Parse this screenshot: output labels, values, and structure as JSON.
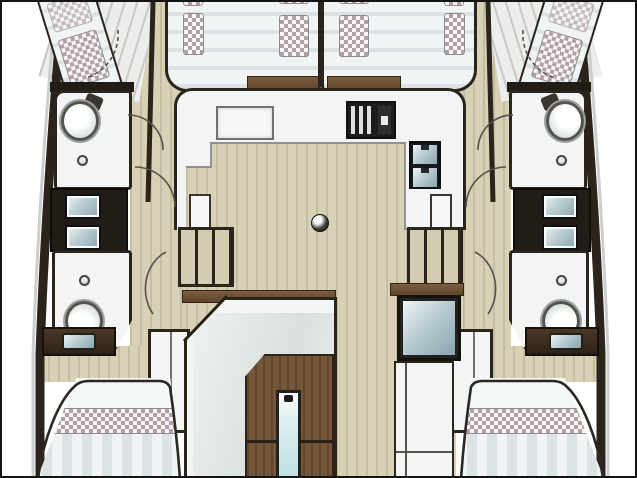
{
  "window": {
    "width": 637,
    "height": 478
  },
  "diagram": {
    "type": "catamaran-interior-deck-plan",
    "view": "top-down",
    "text_labels": [],
    "components": [
      "forward-double-berth-port",
      "forward-double-berth-starboard",
      "hull-diagonal-berth-port",
      "hull-diagonal-berth-starboard",
      "bathroom-forward-port",
      "bathroom-forward-starboard",
      "bathroom-aft-port",
      "bathroom-aft-starboard",
      "toilet",
      "washbasin",
      "vanity-double-sink",
      "salon",
      "galley-counter",
      "galley-stove",
      "galley-double-sink-fridge",
      "counter-hatch",
      "floor-hatch-ring",
      "stairs-port",
      "stairs-starboard",
      "door-swing-arc",
      "companionway-wood-doors",
      "glazed-door-strip",
      "aft-skylight-window",
      "aft-cabin-bed-port",
      "aft-cabin-bed-starboard",
      "vanity-desk-with-seat-port",
      "vanity-desk-with-seat-starboard",
      "wardrobe-port",
      "wardrobe-starboard"
    ]
  },
  "palette": {
    "paper": "#ffffff",
    "frame": "#141414",
    "ink": "#2b241d",
    "wall_dark": "#221c16",
    "wood": "#74563a",
    "wood_dark": "#302417",
    "wood_band_a": "#7d5e3e",
    "wood_band_b": "#5d452c",
    "floor": "#d8d1b5",
    "deck": "#d3ccb0",
    "room": "#f3f5f5",
    "mattress_a": "#f1f4f4",
    "mattress_b": "#dce3e4",
    "pillow_a": "#b1a0a7",
    "pillow_b": "#f8f6f7",
    "glass_a": "#eef5f6",
    "glass_b": "#b9cdd3",
    "glass_c": "#8ba4ae",
    "line_grey": "#8f928d",
    "halo": "#cccfcc"
  }
}
